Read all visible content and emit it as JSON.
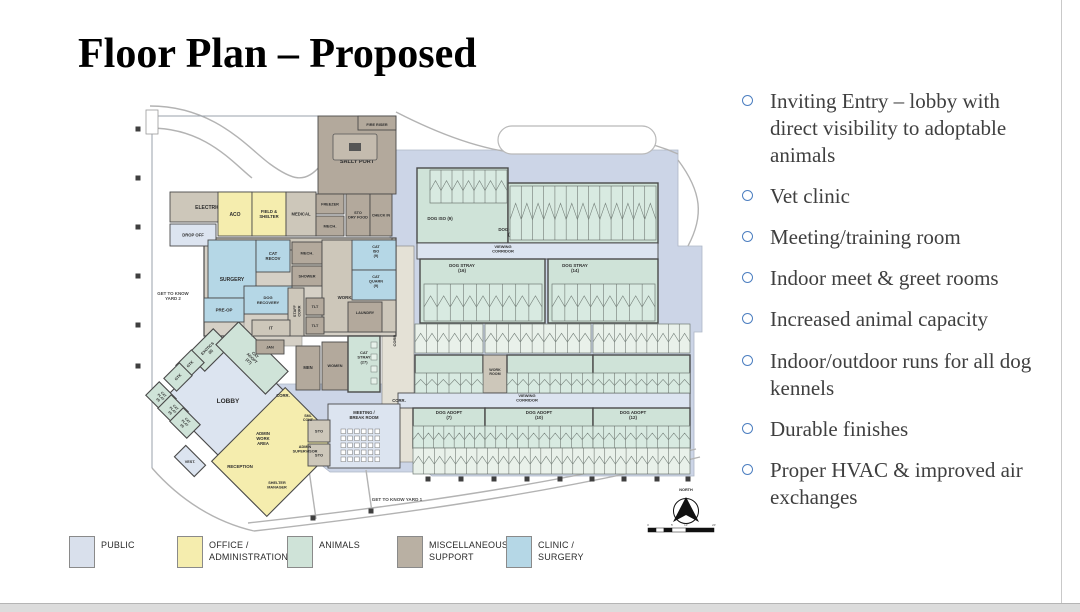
{
  "slide": {
    "title": "Floor Plan – Proposed"
  },
  "bullets": {
    "marker_color": "#4d7fc0",
    "text_color": "#3f3f3f",
    "items": [
      "Inviting Entry – lobby with direct visibility to adoptable animals",
      "Vet clinic",
      "Meeting/training room",
      "Indoor meet & greet rooms",
      "Increased animal capacity",
      "Indoor/outdoor runs for all dog kennels",
      "Durable finishes",
      "Proper HVAC & improved air exchanges"
    ]
  },
  "legend": {
    "items": [
      {
        "label": "PUBLIC",
        "color": "#d9e0ec"
      },
      {
        "label": "OFFICE /\nADMINISTRATION",
        "color": "#f5edae"
      },
      {
        "label": "ANIMALS",
        "color": "#cfe3d8"
      },
      {
        "label": "MISCELLANEOUS /\nSUPPORT",
        "color": "#b9b0a3"
      },
      {
        "label": "CLINIC /\nSURGERY",
        "color": "#b5d7e6"
      }
    ]
  },
  "plan": {
    "colors": {
      "public": "#dce4f0",
      "office": "#f5edae",
      "animals": "#cfe3d8",
      "animalsL": "#e9f1ea",
      "clinic": "#b5d7e6",
      "misc": "#b3a99c",
      "miscL": "#cdc7ba",
      "wall": "#4a4a4a",
      "plate": "#ccd5e7",
      "corr": "#e4e1d6",
      "text": "#2e2e2e"
    },
    "north_label": "NORTH",
    "scale_ticks": [
      "0",
      "5'",
      "10'",
      "20'"
    ],
    "rooms": [
      {
        "id": "sally-port",
        "t": "SALLY PORT",
        "x": 318,
        "y": 116,
        "w": 78,
        "h": 78,
        "c": "misc",
        "fs": 5.5,
        "ly": 163
      },
      {
        "id": "fire-riser",
        "t": "FIRE RISER",
        "x": 358,
        "y": 116,
        "w": 38,
        "h": 14,
        "c": "misc",
        "fs": 3.8,
        "ly": 126
      },
      {
        "id": "electrical",
        "t": "ELECTRICAL",
        "x": 170,
        "y": 192,
        "w": 82,
        "h": 30,
        "c": "miscL",
        "fs": 5
      },
      {
        "id": "drop-off",
        "t": "DROP OFF",
        "x": 170,
        "y": 224,
        "w": 46,
        "h": 22,
        "c": "public",
        "fs": 4.2
      },
      {
        "id": "aco",
        "t": "ACO",
        "x": 218,
        "y": 192,
        "w": 34,
        "h": 44,
        "c": "office",
        "fs": 5
      },
      {
        "id": "field-shelter",
        "t": "FIELD &\nSHELTER",
        "x": 252,
        "y": 192,
        "w": 34,
        "h": 44,
        "c": "office",
        "fs": 4.2
      },
      {
        "id": "medical",
        "t": "MEDICAL",
        "x": 286,
        "y": 192,
        "w": 30,
        "h": 44,
        "c": "miscL",
        "fs": 4.2
      },
      {
        "id": "freezer",
        "t": "FREEZER",
        "x": 316,
        "y": 194,
        "w": 28,
        "h": 20,
        "c": "misc",
        "fs": 3.8
      },
      {
        "id": "mech-1",
        "t": "MECH.",
        "x": 316,
        "y": 216,
        "w": 28,
        "h": 20,
        "c": "misc",
        "fs": 4
      },
      {
        "id": "sto-dry-food",
        "t": "STO\nDRY FOOD",
        "x": 346,
        "y": 194,
        "w": 24,
        "h": 42,
        "c": "misc",
        "fs": 3.8
      },
      {
        "id": "check-in",
        "t": "CHECK IN",
        "x": 370,
        "y": 194,
        "w": 22,
        "h": 42,
        "c": "misc",
        "fs": 3.8
      },
      {
        "id": "staff-corr",
        "t": "STAFF CORR",
        "x": 216,
        "y": 238,
        "w": 176,
        "h": 12,
        "c": "miscL",
        "fs": 4.4,
        "lx": 250,
        "ly": 246
      },
      {
        "id": "dog-iso",
        "t": "DOG ISO (9)",
        "x": 417,
        "y": 168,
        "w": 91,
        "h": 75,
        "c": "animals",
        "fs": 4.4,
        "lx": 440,
        "ly": 220
      },
      {
        "id": "dog-quarn",
        "t": "DOG QUARN\n(15)",
        "x": 508,
        "y": 183,
        "w": 150,
        "h": 60,
        "c": "animals",
        "fs": 4.4,
        "lx": 512,
        "ly": 231
      },
      {
        "id": "viewing-corridor-1",
        "t": "VIEWING\nCORRIDOR",
        "x": 417,
        "y": 243,
        "w": 241,
        "h": 16,
        "c": "public",
        "fs": 4,
        "lx": 503,
        "ly": 248
      },
      {
        "id": "dog-stray-16",
        "t": "DOG STRAY\n(16)",
        "x": 420,
        "y": 259,
        "w": 125,
        "h": 64,
        "c": "animals",
        "fs": 4.4,
        "lx": 462,
        "ly": 267
      },
      {
        "id": "dog-stray-14",
        "t": "DOG STRAY\n(14)",
        "x": 548,
        "y": 259,
        "w": 110,
        "h": 64,
        "c": "animals",
        "fs": 4.4,
        "lx": 575,
        "ly": 267
      },
      {
        "id": "surgery",
        "t": "SURGERY",
        "x": 208,
        "y": 240,
        "w": 48,
        "h": 58,
        "c": "clinic",
        "fs": 5,
        "ly": 281
      },
      {
        "id": "cat-recov",
        "t": "CAT\nRECOV",
        "x": 256,
        "y": 240,
        "w": 34,
        "h": 32,
        "c": "clinic",
        "fs": 4.2
      },
      {
        "id": "mech-2",
        "t": "MECH.",
        "x": 292,
        "y": 242,
        "w": 30,
        "h": 22,
        "c": "misc",
        "fs": 4
      },
      {
        "id": "shower",
        "t": "SHOWER",
        "x": 292,
        "y": 266,
        "w": 30,
        "h": 20,
        "c": "misc",
        "fs": 3.8
      },
      {
        "id": "work-room-1",
        "t": "WORK ROOM",
        "x": 322,
        "y": 240,
        "w": 74,
        "h": 92,
        "c": "miscL",
        "fs": 4.4,
        "lx": 352,
        "ly": 299
      },
      {
        "id": "dog-recovery",
        "t": "DOG\nRECOVERY",
        "x": 244,
        "y": 286,
        "w": 48,
        "h": 28,
        "c": "clinic",
        "fs": 4
      },
      {
        "id": "pre-op",
        "t": "PRE-OP",
        "x": 204,
        "y": 298,
        "w": 40,
        "h": 24,
        "c": "clinic",
        "fs": 4.4
      },
      {
        "id": "staff-corr-v",
        "t": "STAFF\nCORR",
        "x": 288,
        "y": 288,
        "w": 16,
        "h": 48,
        "c": "miscL",
        "fs": 3.8,
        "lrot": -90
      },
      {
        "id": "tlt-1",
        "t": "TLT",
        "x": 306,
        "y": 298,
        "w": 18,
        "h": 17,
        "c": "misc",
        "fs": 3.8
      },
      {
        "id": "tlt-2",
        "t": "TLT",
        "x": 306,
        "y": 317,
        "w": 18,
        "h": 17,
        "c": "misc",
        "fs": 3.8
      },
      {
        "id": "cat-iso",
        "t": "CAT\nISO\n(9)",
        "x": 352,
        "y": 240,
        "w": 44,
        "h": 30,
        "c": "clinic",
        "fs": 3.8,
        "lx": 376,
        "ly": 248
      },
      {
        "id": "cat-quarn",
        "t": "CAT\nQUARN\n(9)",
        "x": 352,
        "y": 270,
        "w": 44,
        "h": 30,
        "c": "clinic",
        "fs": 3.8,
        "lx": 376,
        "ly": 278
      },
      {
        "id": "laundry",
        "t": "LAUNDRY",
        "x": 348,
        "y": 302,
        "w": 34,
        "h": 30,
        "c": "misc",
        "fs": 3.8,
        "ly": 314
      },
      {
        "id": "it-room",
        "t": "IT",
        "x": 252,
        "y": 320,
        "w": 38,
        "h": 16,
        "c": "miscL",
        "fs": 4.2
      },
      {
        "id": "jan",
        "t": "JAN",
        "x": 256,
        "y": 340,
        "w": 28,
        "h": 14,
        "c": "misc",
        "fs": 3.8
      },
      {
        "id": "men",
        "t": "MEN",
        "x": 296,
        "y": 346,
        "w": 24,
        "h": 44,
        "c": "misc",
        "fs": 4.2,
        "ly": 369
      },
      {
        "id": "women",
        "t": "WOMEN",
        "x": 322,
        "y": 342,
        "w": 26,
        "h": 48,
        "c": "misc",
        "fs": 3.8,
        "ly": 367
      },
      {
        "id": "cat-stray",
        "t": "CAT\nSTRAY\n(27)",
        "x": 348,
        "y": 336,
        "w": 32,
        "h": 56,
        "c": "animals",
        "fs": 4,
        "ly": 354
      },
      {
        "id": "dog-adopt-8a",
        "t": "DOG ADOPT\n(8)",
        "x": 415,
        "y": 355,
        "w": 68,
        "h": 38,
        "c": "animals",
        "fs": 4.4,
        "ly": 377
      },
      {
        "id": "work-room-2",
        "t": "WORK\nROOM",
        "x": 483,
        "y": 355,
        "w": 24,
        "h": 38,
        "c": "miscL",
        "fs": 3.6,
        "ly": 371
      },
      {
        "id": "dog-adopt-8b",
        "t": "DOG ADOPT\n(8)",
        "x": 507,
        "y": 355,
        "w": 86,
        "h": 38,
        "c": "animals",
        "fs": 4.4,
        "ly": 377
      },
      {
        "id": "dog-adopt-11",
        "t": "DOG ADOPT\n(11)",
        "x": 593,
        "y": 355,
        "w": 97,
        "h": 38,
        "c": "animals",
        "fs": 4.4,
        "lx": 628,
        "ly": 377
      },
      {
        "id": "viewing-corridor-2",
        "t": "VIEWING\nCORRIDOR",
        "x": 398,
        "y": 393,
        "w": 292,
        "h": 15,
        "c": "public",
        "fs": 4,
        "lx": 527,
        "ly": 397
      },
      {
        "id": "dog-adopt-7",
        "t": "DOG ADOPT\n(7)",
        "x": 413,
        "y": 408,
        "w": 72,
        "h": 40,
        "c": "animals",
        "fs": 4.4,
        "ly": 414
      },
      {
        "id": "dog-adopt-10",
        "t": "DOG ADOPT\n(10)",
        "x": 485,
        "y": 408,
        "w": 108,
        "h": 40,
        "c": "animals",
        "fs": 4.4,
        "ly": 414
      },
      {
        "id": "dog-adopt-12",
        "t": "DOG ADOPT\n(12)",
        "x": 593,
        "y": 408,
        "w": 97,
        "h": 40,
        "c": "animals",
        "fs": 4.4,
        "lx": 633,
        "ly": 414
      },
      {
        "id": "meeting-room",
        "t": "MEETING /\nBREAK ROOM",
        "x": 328,
        "y": 404,
        "w": 72,
        "h": 64,
        "c": "public",
        "fs": 4.2,
        "lx": 364,
        "ly": 414
      },
      {
        "id": "sto-1",
        "t": "STO",
        "x": 308,
        "y": 420,
        "w": 22,
        "h": 22,
        "c": "miscL",
        "fs": 4
      },
      {
        "id": "sto-2",
        "t": "STO",
        "x": 308,
        "y": 444,
        "w": 22,
        "h": 22,
        "c": "miscL",
        "fs": 4
      }
    ],
    "rot_rooms": [
      {
        "id": "lobby",
        "t": "LOBBY",
        "cx": 228,
        "cy": 400,
        "w": 92,
        "h": 92,
        "rot": 45,
        "c": "public",
        "fs": 6.5,
        "hlabel": true,
        "ly": 403
      },
      {
        "id": "admin-wing",
        "t": "",
        "cx": 276,
        "cy": 452,
        "w": 104,
        "h": 78,
        "rot": -45,
        "c": "office"
      },
      {
        "id": "vest",
        "t": "VEST.",
        "cx": 190,
        "cy": 461,
        "w": 28,
        "h": 16,
        "rot": 45,
        "c": "public",
        "fs": 3.8,
        "hlabel": true,
        "ly": 463
      },
      {
        "id": "exotics",
        "t": "EXOTICS\n(8)",
        "cx": 209,
        "cy": 350,
        "w": 36,
        "h": 24,
        "rot": -45,
        "c": "animals",
        "fs": 3.8
      },
      {
        "id": "gtk-1",
        "t": "GTK",
        "cx": 190,
        "cy": 364,
        "w": 22,
        "h": 18,
        "rot": -45,
        "c": "animals",
        "fs": 3.8
      },
      {
        "id": "gtk-2",
        "t": "GTK",
        "cx": 178,
        "cy": 377,
        "w": 22,
        "h": 18,
        "rot": -45,
        "c": "animals",
        "fs": 3.8
      },
      {
        "id": "cat-adopt",
        "t": "CAT\nADOPT\n(27)",
        "cx": 252,
        "cy": 358,
        "w": 70,
        "h": 32,
        "rot": 45,
        "c": "animals",
        "fs": 3.8
      },
      {
        "id": "cat-play-1",
        "t": "CAT\nPLAY\n(4)",
        "cx": 161,
        "cy": 397,
        "w": 24,
        "h": 19,
        "rot": 45,
        "c": "animals",
        "fs": 3.2
      },
      {
        "id": "cat-play-2",
        "t": "CAT\nPLAY\n(4)",
        "cx": 173,
        "cy": 410,
        "w": 24,
        "h": 19,
        "rot": 45,
        "c": "animals",
        "fs": 3.2
      },
      {
        "id": "cat-play-3",
        "t": "CAT\nPLAY\n(4)",
        "cx": 185,
        "cy": 423,
        "w": 24,
        "h": 19,
        "rot": 45,
        "c": "animals",
        "fs": 3.2
      }
    ],
    "labels": [
      {
        "t": "ADMIN\nWORK\nAREA",
        "x": 263,
        "y": 435,
        "fs": 4.2
      },
      {
        "t": "RECEPTION",
        "x": 240,
        "y": 468,
        "fs": 4.4
      },
      {
        "t": "SHELTER\nMANAGER",
        "x": 277,
        "y": 484,
        "fs": 3.8
      },
      {
        "t": "ADMIN\nSUPERVISOR",
        "x": 305,
        "y": 448,
        "fs": 3.8
      },
      {
        "t": "SML\nCONF",
        "x": 308,
        "y": 417,
        "fs": 3.6
      },
      {
        "t": "CORR.",
        "x": 396,
        "y": 340,
        "fs": 4,
        "rot": -90
      },
      {
        "t": "CORR.",
        "x": 283,
        "y": 397,
        "fs": 4.2
      },
      {
        "t": "CORR.",
        "x": 399,
        "y": 402,
        "fs": 4.2
      },
      {
        "t": "GET TO KNOW\nYARD 2",
        "x": 173,
        "y": 295,
        "fs": 4.4,
        "col": "#4a4a4a"
      },
      {
        "t": "GET TO KNOW YARD 1",
        "x": 397,
        "y": 501,
        "fs": 4.6,
        "col": "#4a4a4a"
      },
      {
        "t": "NORTH",
        "x": 686,
        "y": 491,
        "fs": 3.8,
        "col": "#222222"
      }
    ],
    "stalls": [
      {
        "x": 430,
        "y": 170,
        "w": 77,
        "h": 33,
        "n": 7
      },
      {
        "x": 510,
        "y": 186,
        "w": 146,
        "h": 54,
        "n": 13
      },
      {
        "x": 424,
        "y": 284,
        "w": 118,
        "h": 37,
        "n": 9
      },
      {
        "x": 552,
        "y": 284,
        "w": 103,
        "h": 37,
        "n": 8
      },
      {
        "x": 415,
        "y": 324,
        "w": 68,
        "h": 29,
        "n": 6,
        "lt": 1
      },
      {
        "x": 485,
        "y": 324,
        "w": 106,
        "h": 29,
        "n": 9,
        "lt": 1
      },
      {
        "x": 593,
        "y": 324,
        "w": 97,
        "h": 29,
        "n": 9,
        "lt": 1
      },
      {
        "x": 415,
        "y": 373,
        "w": 68,
        "h": 20,
        "n": 6
      },
      {
        "x": 507,
        "y": 373,
        "w": 86,
        "h": 20,
        "n": 8
      },
      {
        "x": 593,
        "y": 373,
        "w": 97,
        "h": 20,
        "n": 9
      },
      {
        "x": 413,
        "y": 426,
        "w": 72,
        "h": 22,
        "n": 7
      },
      {
        "x": 485,
        "y": 426,
        "w": 108,
        "h": 22,
        "n": 10
      },
      {
        "x": 593,
        "y": 426,
        "w": 97,
        "h": 22,
        "n": 9
      },
      {
        "x": 413,
        "y": 448,
        "w": 277,
        "h": 26,
        "n": 26,
        "lt": 1
      }
    ],
    "columns": [
      [
        138,
        129
      ],
      [
        138,
        178
      ],
      [
        138,
        227
      ],
      [
        138,
        276
      ],
      [
        138,
        325
      ],
      [
        138,
        366
      ],
      [
        313,
        518
      ],
      [
        371,
        511
      ],
      [
        428,
        479
      ],
      [
        461,
        479
      ],
      [
        494,
        479
      ],
      [
        527,
        479
      ],
      [
        560,
        479
      ],
      [
        592,
        479
      ],
      [
        624,
        479
      ],
      [
        657,
        479
      ],
      [
        688,
        479
      ]
    ],
    "site_polys": [
      {
        "pts": "390,150 678,150 678,246 702,246 702,332 694,332 694,476 432,476 415,462 390,462",
        "c": "plate"
      },
      {
        "pts": "250,384 418,384 418,472 330,472 250,408",
        "c": "plate"
      }
    ],
    "curves": [
      "M 150,106 C 215,106 248,148 270,164 S 305,184 320,166",
      "M 150,128 C 205,128 232,162 252,178",
      "M 396,112 C 470,150 525,160 560,150 S 630,132 678,154",
      "M 254,531 C 420,512 565,490 700,457",
      "M 248,523 C 410,505 560,483 696,449",
      "M 678,160 C 702,192 704,216 688,246",
      "M 152,468 C 180,500 215,522 254,531",
      "M 309,470 L 316,519",
      "M 366,470 L 372,512"
    ]
  }
}
